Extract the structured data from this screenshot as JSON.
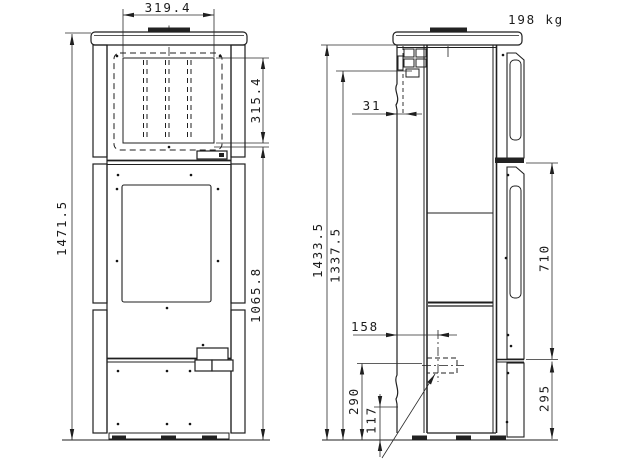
{
  "title": "Stove technical drawing, front and side views",
  "weight_label": "198 kg",
  "front_view": {
    "dim_glass_width": "319.4",
    "dim_glass_height": "315.4",
    "dim_overall_height": "1471.5",
    "dim_glass_bottom_from_floor": "1065.8"
  },
  "side_view": {
    "dim_height_to_top_rear": "1433.5",
    "dim_flue_center_height": "1337.5",
    "dim_flue_offset": "31",
    "dim_inlet_offset": "158",
    "dim_inlet_center_height": "290",
    "dim_bottom_detail_height": "117",
    "dim_side_panel_length": "710",
    "dim_lower_panel_height": "295"
  }
}
